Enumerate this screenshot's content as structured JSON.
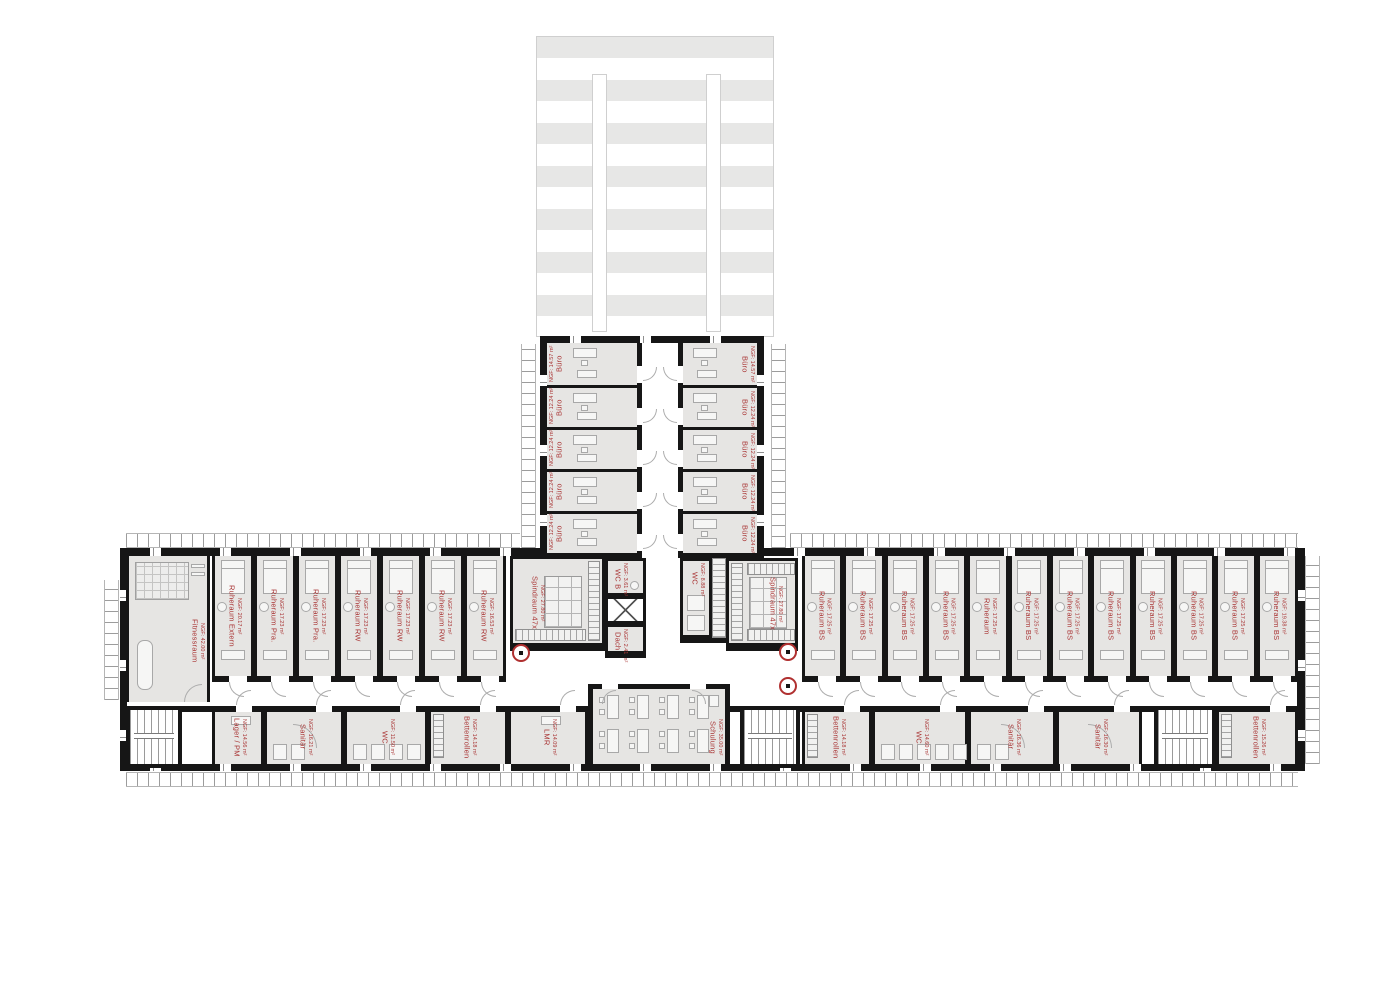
{
  "colors": {
    "label_red": "#a93434",
    "wall": "#161616",
    "room_fill": "#e6e5e3",
    "roof_stripe": "#e7e7e6"
  },
  "top_wing": {
    "offices_left": [
      {
        "name": "Büro",
        "area": "NGF: 14.57 m²"
      },
      {
        "name": "Büro",
        "area": "NGF: 12.24 m²"
      },
      {
        "name": "Büro",
        "area": "NGF: 12.24 m²"
      },
      {
        "name": "Büro",
        "area": "NGF: 12.24 m²"
      },
      {
        "name": "Büro",
        "area": "NGF: 12.24 m²"
      }
    ],
    "offices_right": [
      {
        "name": "Büro",
        "area": "NGF: 14.57 m²"
      },
      {
        "name": "Büro",
        "area": "NGF: 12.24 m²"
      },
      {
        "name": "Büro",
        "area": "NGF: 12.24 m²"
      },
      {
        "name": "Büro",
        "area": "NGF: 12.24 m²"
      },
      {
        "name": "Büro",
        "area": "NGF: 12.24 m²"
      }
    ]
  },
  "west_wing": {
    "fitness": {
      "name": "Fitnessraum",
      "area": "NGF: 42.00 m²"
    },
    "rooms": [
      {
        "name": "Ruheraum Extern",
        "area": "NGF: 20.17 m²"
      },
      {
        "name": "Ruheraum Pra.",
        "area": "NGF: 17.23 m²"
      },
      {
        "name": "Ruheraum Pra.",
        "area": "NGF: 17.23 m²"
      },
      {
        "name": "Ruheraum RW",
        "area": "NGF: 17.23 m²"
      },
      {
        "name": "Ruheraum RW",
        "area": "NGF: 17.23 m²"
      },
      {
        "name": "Ruheraum RW",
        "area": "NGF: 17.23 m²"
      },
      {
        "name": "Ruheraum RW",
        "area": "NGF: 16.53 m²"
      }
    ],
    "bottom_rooms": [
      {
        "name": "Lager / PM",
        "area": "NGF: 14.56 m²"
      },
      {
        "name": "Sanitär",
        "area": "NGF: 16.21 m²"
      },
      {
        "name": "WC",
        "area": "NGF: 11.50 m²"
      },
      {
        "name": "Bettenrollen",
        "area": "NGF: 14.18 m²"
      },
      {
        "name": "LMR",
        "area": "NGF: 14.09 m²"
      }
    ]
  },
  "east_wing": {
    "rooms": [
      {
        "name": "Ruheraum BS",
        "area": "NGF: 17.25 m²"
      },
      {
        "name": "Ruheraum BS",
        "area": "NGF: 17.25 m²"
      },
      {
        "name": "Ruheraum BS",
        "area": "NGF: 17.25 m²"
      },
      {
        "name": "Ruheraum BS",
        "area": "NGF: 17.25 m²"
      },
      {
        "name": "Ruheraum",
        "area": "NGF: 17.25 m²"
      },
      {
        "name": "Ruheraum BS",
        "area": "NGF: 17.25 m²"
      },
      {
        "name": "Ruheraum BS",
        "area": "NGF: 17.25 m²"
      },
      {
        "name": "Ruheraum BS",
        "area": "NGF: 17.25 m²"
      },
      {
        "name": "Ruheraum BS",
        "area": "NGF: 17.25 m²"
      },
      {
        "name": "Ruheraum BS",
        "area": "NGF: 17.25 m²"
      },
      {
        "name": "Ruheraum BS",
        "area": "NGF: 17.25 m²"
      },
      {
        "name": "Ruheraum BS",
        "area": "NGF: 19.38 m²"
      }
    ],
    "bottom_rooms": [
      {
        "name": "Bettenrollen",
        "area": "NGF: 14.18 m²"
      },
      {
        "name": "WC",
        "area": "NGF: 14.60 m²"
      },
      {
        "name": "Sanitär",
        "area": "NGF: 16.36 m²"
      },
      {
        "name": "Sanitär",
        "area": "NGF: 16.30 m²"
      },
      {
        "name": "Bettenrollen",
        "area": "NGF: 15.26 m²"
      }
    ]
  },
  "center": {
    "spindraum_left": {
      "name": "Spindraum 47x",
      "area": "NGF: 27.80 m²"
    },
    "spindraum_right": {
      "name": "Spindraum 47x",
      "area": "NGF: 27.80 m²"
    },
    "wc_b": {
      "name": "WC B",
      "area": "NGF: 3.61 m²"
    },
    "dach": {
      "name": "Dach",
      "area": "NGF: 2.41 m²"
    },
    "wc_mid": {
      "name": "WC",
      "area": "NGF: 8.88 m²"
    },
    "schulung": {
      "name": "Schulung",
      "area": "NGF: 35.00 m²"
    }
  }
}
